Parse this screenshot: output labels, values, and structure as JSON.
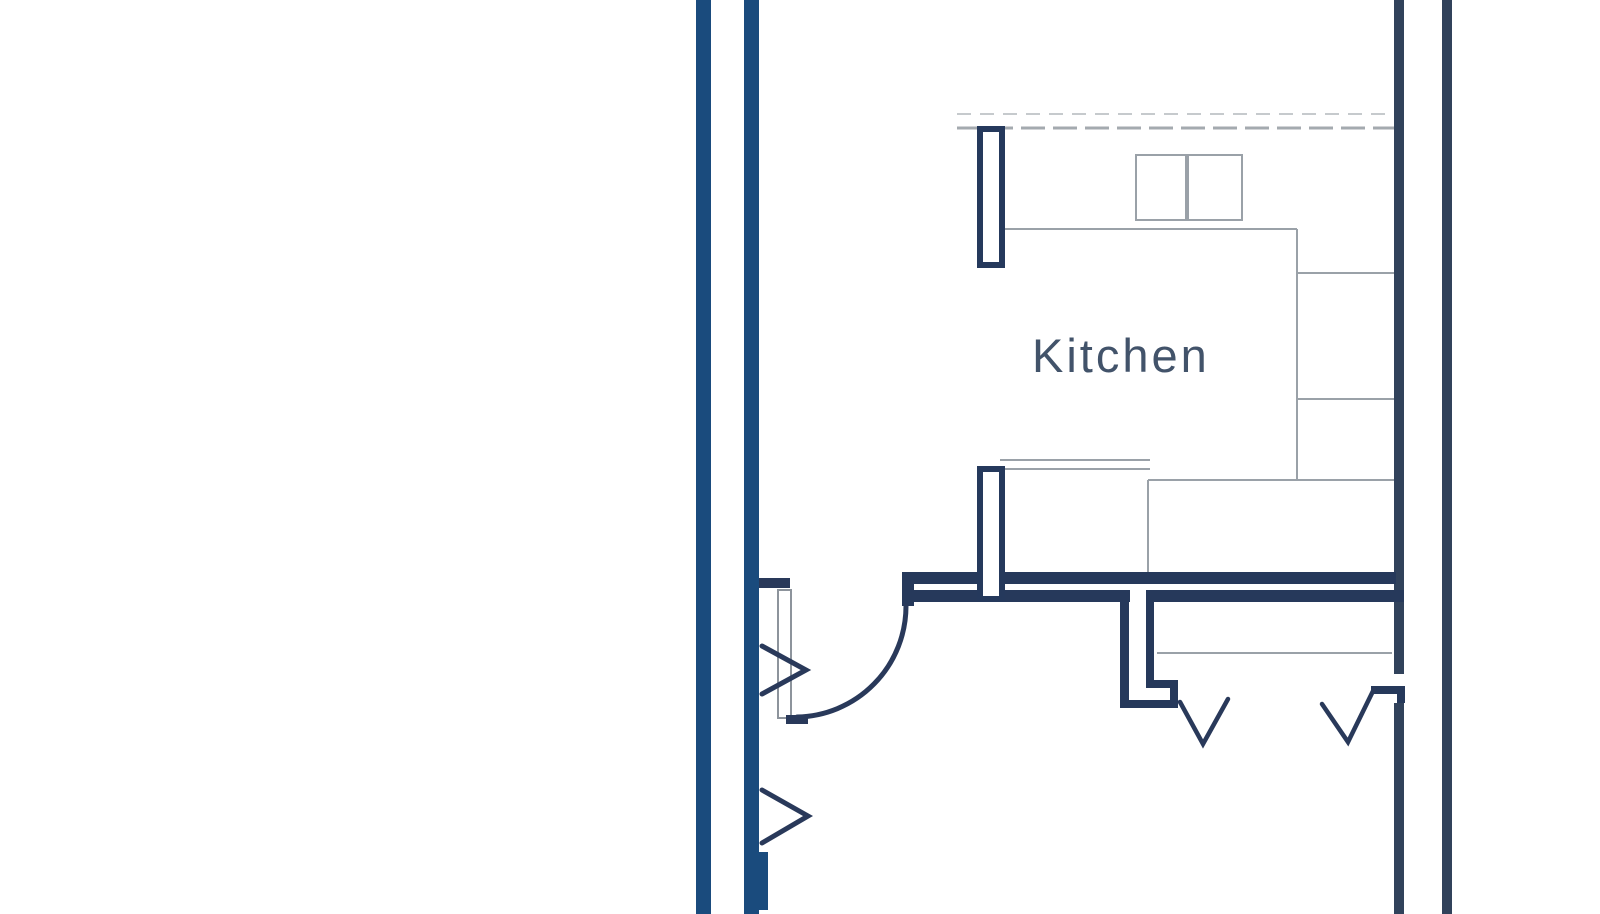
{
  "floorplan": {
    "room_label": "Kitchen",
    "colors": {
      "background": "#ffffff",
      "exterior_wall_blue": "#1a4b7d",
      "interior_wall_navy": "#26395b",
      "right_wall_slate": "#31425b",
      "door_symbol_navy": "#29395a",
      "fixture_line_gray": "#9aa1a8",
      "dashed_line_gray": "#a4aaaf",
      "label_text": "#42536a"
    },
    "rooms": [
      {
        "label": "Kitchen"
      }
    ],
    "fixtures": [
      {
        "name": "double-sink"
      },
      {
        "name": "counter-run-top"
      },
      {
        "name": "appliance-column-right"
      },
      {
        "name": "peninsula-counter"
      },
      {
        "name": "wall-pillar-top"
      },
      {
        "name": "wall-pillar-bottom"
      },
      {
        "name": "closet-rail-line"
      },
      {
        "name": "dashed-overhead-line"
      }
    ],
    "doors": [
      {
        "name": "entry-door-swing-arc"
      },
      {
        "name": "left-wall-door-chevron-upper"
      },
      {
        "name": "left-wall-door-chevron-lower"
      },
      {
        "name": "lower-room-door-chevron-left"
      },
      {
        "name": "lower-room-door-chevron-right"
      }
    ]
  }
}
